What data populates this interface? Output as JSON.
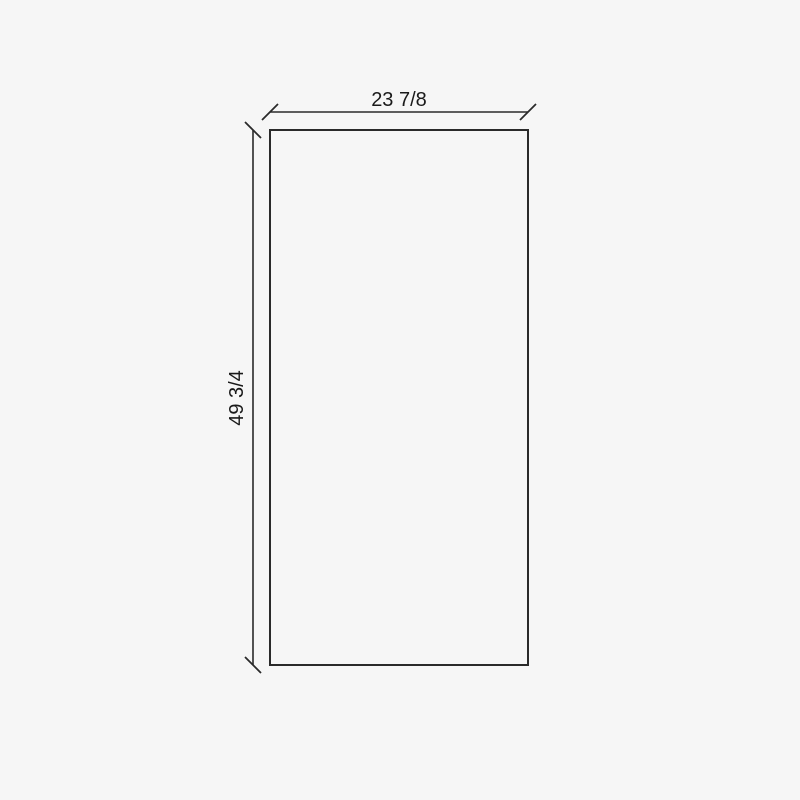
{
  "drawing": {
    "type": "panel-dimension-drawing",
    "panel": {
      "outline": "rectangle"
    },
    "dimensions": {
      "width": {
        "label": "23 7/8",
        "position": "top"
      },
      "height": {
        "label": "49 3/4",
        "position": "left",
        "text_rotation_deg": -90
      }
    },
    "colors": {
      "background": "#f6f6f6",
      "line": "#2a2a2a",
      "text": "#1a1a1a"
    }
  }
}
